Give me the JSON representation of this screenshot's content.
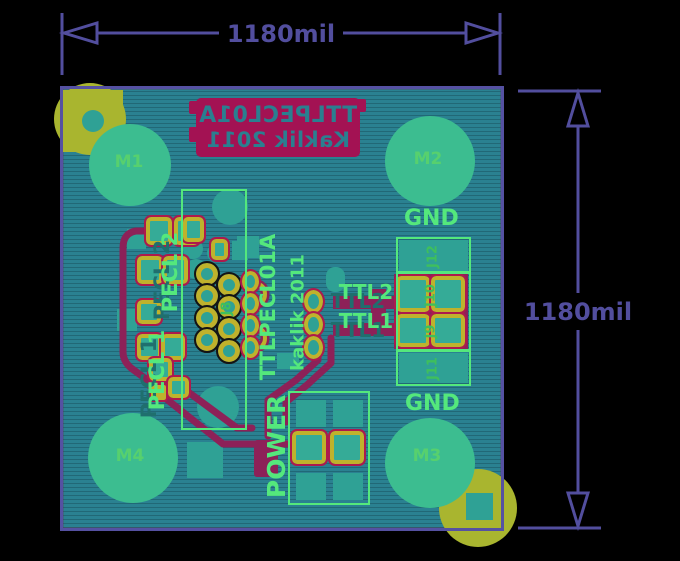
{
  "app": {
    "description": "PCB board layout preview with dimension annotations"
  },
  "colors": {
    "background": "#000000",
    "dimension": "#524e9e",
    "board_fill": "#2a8191",
    "board_border": "#5551a2",
    "copper_trace": "#8d2158",
    "silk_red_block": "#a31253",
    "silk_green": "#54e87c",
    "pad_yellow": "#bfb22c",
    "pad_outline_crimson": "#ad1a4d",
    "pad_teal": "#35ab97",
    "mount_hole_green": "#3cbd90",
    "corner_pad_olive": "#a9b52f"
  },
  "dimensions": {
    "top": {
      "label": "1180mil"
    },
    "right": {
      "label": "1180mil"
    }
  },
  "silkscreen": {
    "red_block": {
      "line1": "TTLPECL01A",
      "line2": "Kaklik 2011",
      "note": "mirrored text"
    },
    "title_vertical": "TTLPECL01A",
    "author_vertical": "kaklik 2011",
    "gnd_top": "GND",
    "gnd_bottom": "GND",
    "ttl2": "TTL2",
    "ttl1": "TTL1",
    "pecl1": "PECL 1",
    "pecl2": "PECL 2",
    "power": "POWER"
  },
  "mount_holes": [
    {
      "label": "M1"
    },
    {
      "label": "M2"
    },
    {
      "label": "M3"
    },
    {
      "label": "M4"
    }
  ],
  "connectors": [
    {
      "label": "J8"
    },
    {
      "label": "J9"
    },
    {
      "label": "J10"
    },
    {
      "label": "J11"
    },
    {
      "label": "J12"
    }
  ]
}
